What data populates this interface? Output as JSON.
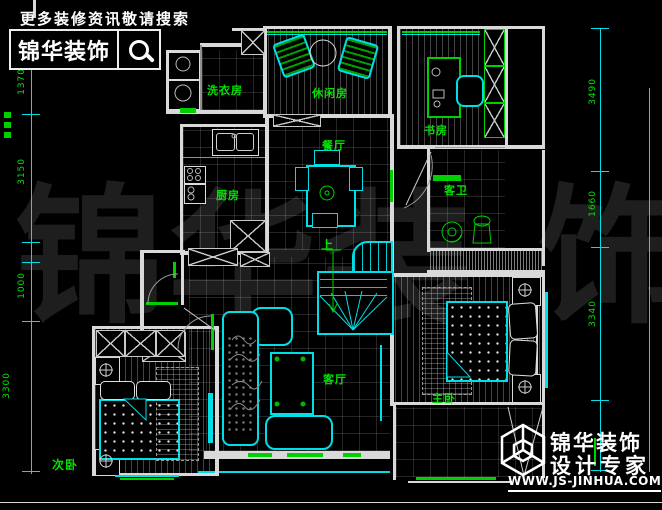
{
  "header": {
    "promo": "更多装修资讯敬请搜索",
    "brand": "锦华装饰",
    "search_icon": "magnifier"
  },
  "watermark": {
    "chars": [
      "锦",
      "华",
      "装",
      "饰"
    ]
  },
  "rooms": {
    "laundry": "洗衣房",
    "leisure": "休闲房",
    "study": "书房",
    "dining": "餐厅",
    "kitchen": "厨房",
    "guest_bath": "客卫",
    "living": "客厅",
    "master": "主卧",
    "secondary": "次卧",
    "stairs_up": "上"
  },
  "dims": {
    "left": [
      "1370",
      "3150",
      "1000",
      "3300"
    ],
    "right": [
      "3490",
      "1660",
      "3340"
    ]
  },
  "footer": {
    "brand": "锦华装饰",
    "tagline": "设计专家",
    "website": "WWW.JS-JINHUA.COM"
  },
  "colors": {
    "background": "#000000",
    "walls": "#d9d9d9",
    "windows_green": "#00cf00",
    "lines_cyan": "#00dfe6",
    "labels_green": "#00e400",
    "watermark": "#1e1e1e"
  }
}
